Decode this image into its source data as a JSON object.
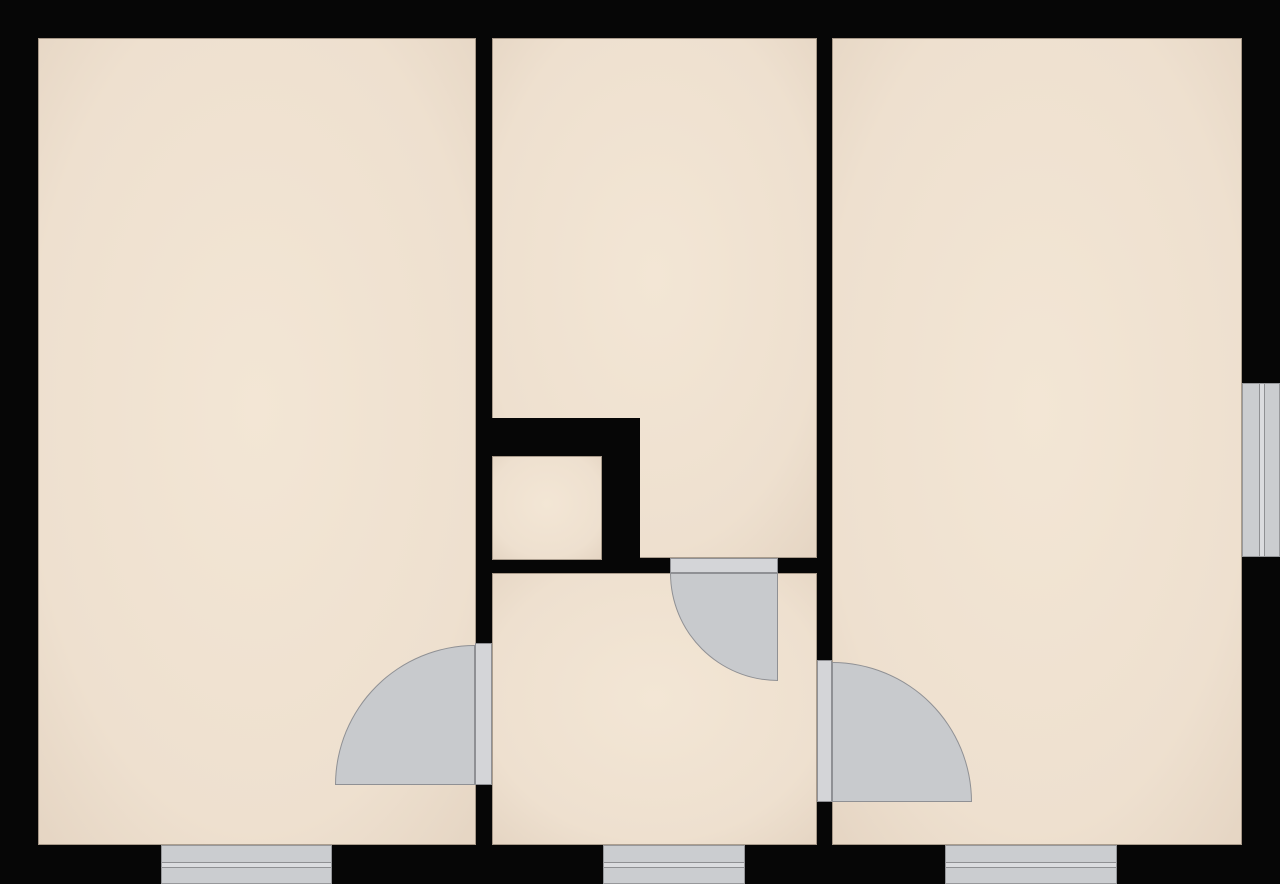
{
  "meta": {
    "title": "Apartment floor plan",
    "canvas": {
      "width": 1280,
      "height": 884
    }
  },
  "palette": {
    "wall": "#060606",
    "floor_center": "#f3e6d5",
    "floor_mid": "#eee0cf",
    "floor_edge": "#dccab7",
    "door_leaf": "#d4d5d8",
    "door_swing": "#c8cacd",
    "door_stroke": "#8f9094",
    "window_glass": "#cbcdd0",
    "window_mid": "#dbdcdf",
    "window_line": "#8f9093",
    "room_outline": "rgba(64,50,38,0.38)"
  },
  "rooms": [
    {
      "name": "room-left",
      "x": 38,
      "y": 38,
      "w": 438,
      "h": 807,
      "z": 1
    },
    {
      "name": "room-top-middle",
      "x": 492,
      "y": 38,
      "w": 325,
      "h": 520,
      "z": 1
    },
    {
      "name": "room-right",
      "x": 832,
      "y": 38,
      "w": 410,
      "h": 807,
      "z": 1
    },
    {
      "name": "room-hallway",
      "x": 492,
      "y": 573,
      "w": 325,
      "h": 272,
      "z": 1
    },
    {
      "name": "room-closet",
      "x": 492,
      "y": 456,
      "w": 110,
      "h": 104,
      "z": 3
    }
  ],
  "wall_patches": [
    {
      "name": "closet-walls",
      "x": 476,
      "y": 418,
      "w": 164,
      "h": 155,
      "z": 2
    }
  ],
  "doors": [
    {
      "name": "door-left-room-to-hallway",
      "leaf": {
        "x": 475,
        "y": 643,
        "w": 17,
        "h": 142
      },
      "swing": {
        "x": 335,
        "y": 645,
        "w": 140,
        "h": 140,
        "round_corner": "top-left"
      }
    },
    {
      "name": "door-top-middle-room-to-hallway",
      "leaf": {
        "x": 670,
        "y": 558,
        "w": 108,
        "h": 15
      },
      "swing": {
        "x": 670,
        "y": 573,
        "w": 108,
        "h": 108,
        "round_corner": "bottom-left"
      }
    },
    {
      "name": "door-hallway-to-right-room",
      "leaf": {
        "x": 817,
        "y": 660,
        "w": 15,
        "h": 142
      },
      "swing": {
        "x": 832,
        "y": 662,
        "w": 140,
        "h": 140,
        "round_corner": "top-right"
      }
    }
  ],
  "windows": [
    {
      "name": "window-bottom-left",
      "x": 161,
      "y": 845,
      "w": 171,
      "h": 39,
      "orientation": "horizontal"
    },
    {
      "name": "window-bottom-middle",
      "x": 603,
      "y": 845,
      "w": 142,
      "h": 39,
      "orientation": "horizontal"
    },
    {
      "name": "window-bottom-right",
      "x": 945,
      "y": 845,
      "w": 172,
      "h": 39,
      "orientation": "horizontal"
    },
    {
      "name": "window-east",
      "x": 1242,
      "y": 383,
      "w": 38,
      "h": 174,
      "orientation": "vertical"
    }
  ]
}
